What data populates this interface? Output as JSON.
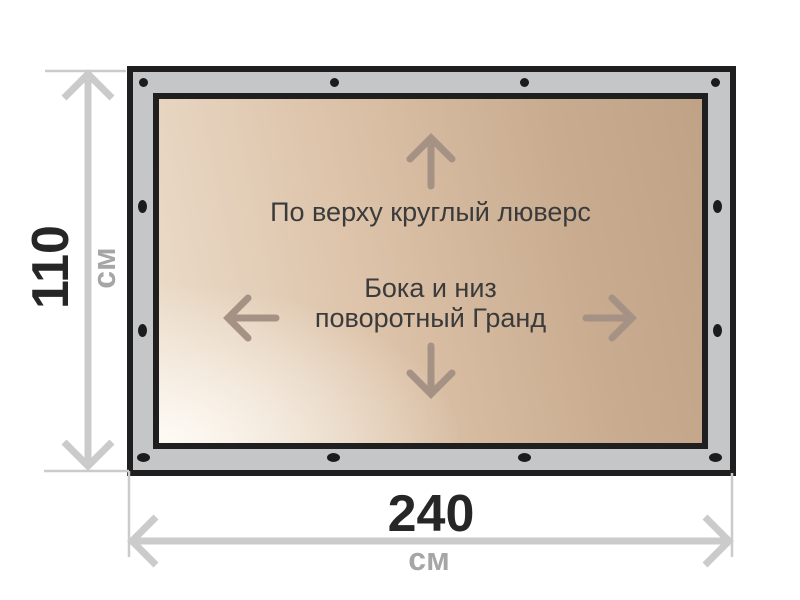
{
  "banner": {
    "face_note_top": "По верху круглый люверс",
    "face_note_bottom_line1": "Бока и низ",
    "face_note_bottom_line2": "поворотный Гранд",
    "grommets": {
      "top_edge": 4,
      "bottom_edge": 4,
      "left_edge_middle": 2,
      "right_edge_middle": 2
    }
  },
  "dimensions": {
    "height": {
      "value": "110",
      "unit": "см"
    },
    "width": {
      "value": "240",
      "unit": "см"
    }
  },
  "icons": {
    "inner_up": "up-arrow-icon",
    "inner_down": "down-arrow-icon",
    "inner_left": "left-arrow-icon",
    "inner_right": "right-arrow-icon",
    "height_dimension": "double-arrow-vertical-icon",
    "width_dimension": "double-arrow-horizontal-icon",
    "grommet": "grommet-dot-icon"
  },
  "colors": {
    "frame_grey": "#c5c6c7",
    "outline_black": "#1f1f1f",
    "dimension_grey": "#cbcbcb",
    "inner_arrow": "#a59284",
    "face_light": "#f6f1ea",
    "face_tan": "#c0a287",
    "note_text": "#3b3b3b",
    "value_text": "#262626",
    "unit_text": "#a6a6a6"
  }
}
